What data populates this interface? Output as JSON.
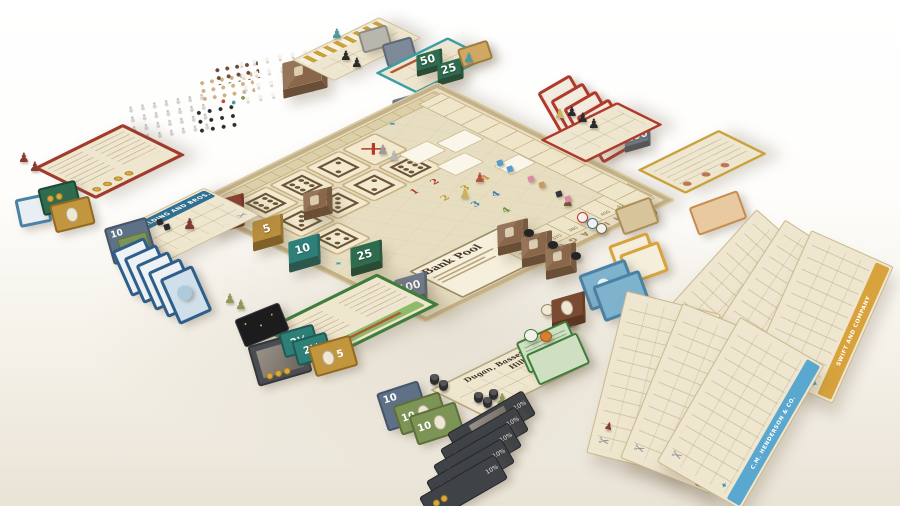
{
  "board": {
    "bank_pool_label": "Bank Pool",
    "edge_label": "CHICAGO",
    "dice": [
      "⚅",
      "⚅",
      "⚁",
      "✕",
      "⚂",
      "⚂",
      "⚁",
      "⚅",
      "⚃"
    ],
    "price_track": [
      "350",
      "360",
      "370",
      "380",
      "390",
      "400",
      "410",
      "420"
    ],
    "demand_red": "1 2 3 4",
    "demand_yellow": "2 3 4",
    "demand_blue": "3 4",
    "demand_green": "4"
  },
  "money": {
    "d2h": "2½",
    "d5": "5",
    "d10": "10",
    "d25": "25",
    "d50": "50",
    "d100": "100"
  },
  "companies": {
    "spalding": "A.G. SPALDING AND BROS.",
    "dugan": "Dugan, Bassett & Hills Co.",
    "fairbank": "N.K. FAIRBANK & CO.",
    "swift": "SWIFT AND COMPANY",
    "libby": "LIBBY, MCNEILL & LIBBY",
    "anglo": "ANGLO-AMERICAN PROVISION CO.",
    "brunswick": "BRUNSWICK-BALKE-COLLENDER CO.",
    "henderson": "C.M. HENDERSON & CO."
  },
  "shares": {
    "dividend": "10%"
  },
  "tiles": {
    "star": "4"
  }
}
